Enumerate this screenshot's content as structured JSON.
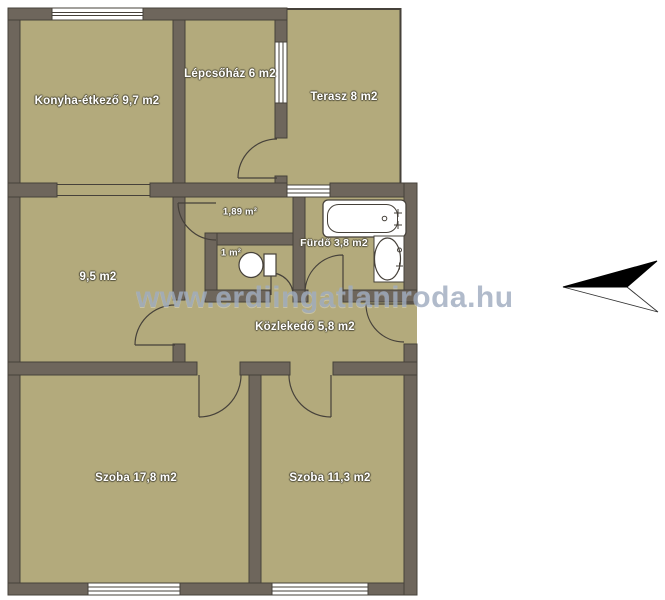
{
  "watermark": {
    "text": "www.erdiingatlaniroda.hu"
  },
  "rooms": [
    {
      "id": "konyha-etkezo",
      "label": "Konyha-étkező 9,7 m2"
    },
    {
      "id": "lepcsohaz",
      "label": "Lépcsőház 6 m2"
    },
    {
      "id": "terasz",
      "label": "Terasz 8 m2"
    },
    {
      "id": "eloter",
      "label": "1,89 m²"
    },
    {
      "id": "wc",
      "label": "1 m²"
    },
    {
      "id": "furdo",
      "label": "Fürdő 3,8 m2"
    },
    {
      "id": "felszoba",
      "label": "9,5 m2"
    },
    {
      "id": "kozlekedo",
      "label": "Közlekedő 5,8 m2"
    },
    {
      "id": "szoba-nagy",
      "label": "Szoba 17,8 m2"
    },
    {
      "id": "szoba-kicsi",
      "label": "Szoba 11,3 m2"
    }
  ],
  "icons": {
    "bathtub": "bathtub-icon",
    "sink": "sink-icon",
    "toilet": "toilet-icon",
    "north_arrow": "north-arrow-icon"
  },
  "colors": {
    "floor": "#b3aa7c",
    "wall": "#6e665c",
    "line": "#46413a",
    "watermark": "#a0adc0",
    "fixture": "#ffffff"
  }
}
